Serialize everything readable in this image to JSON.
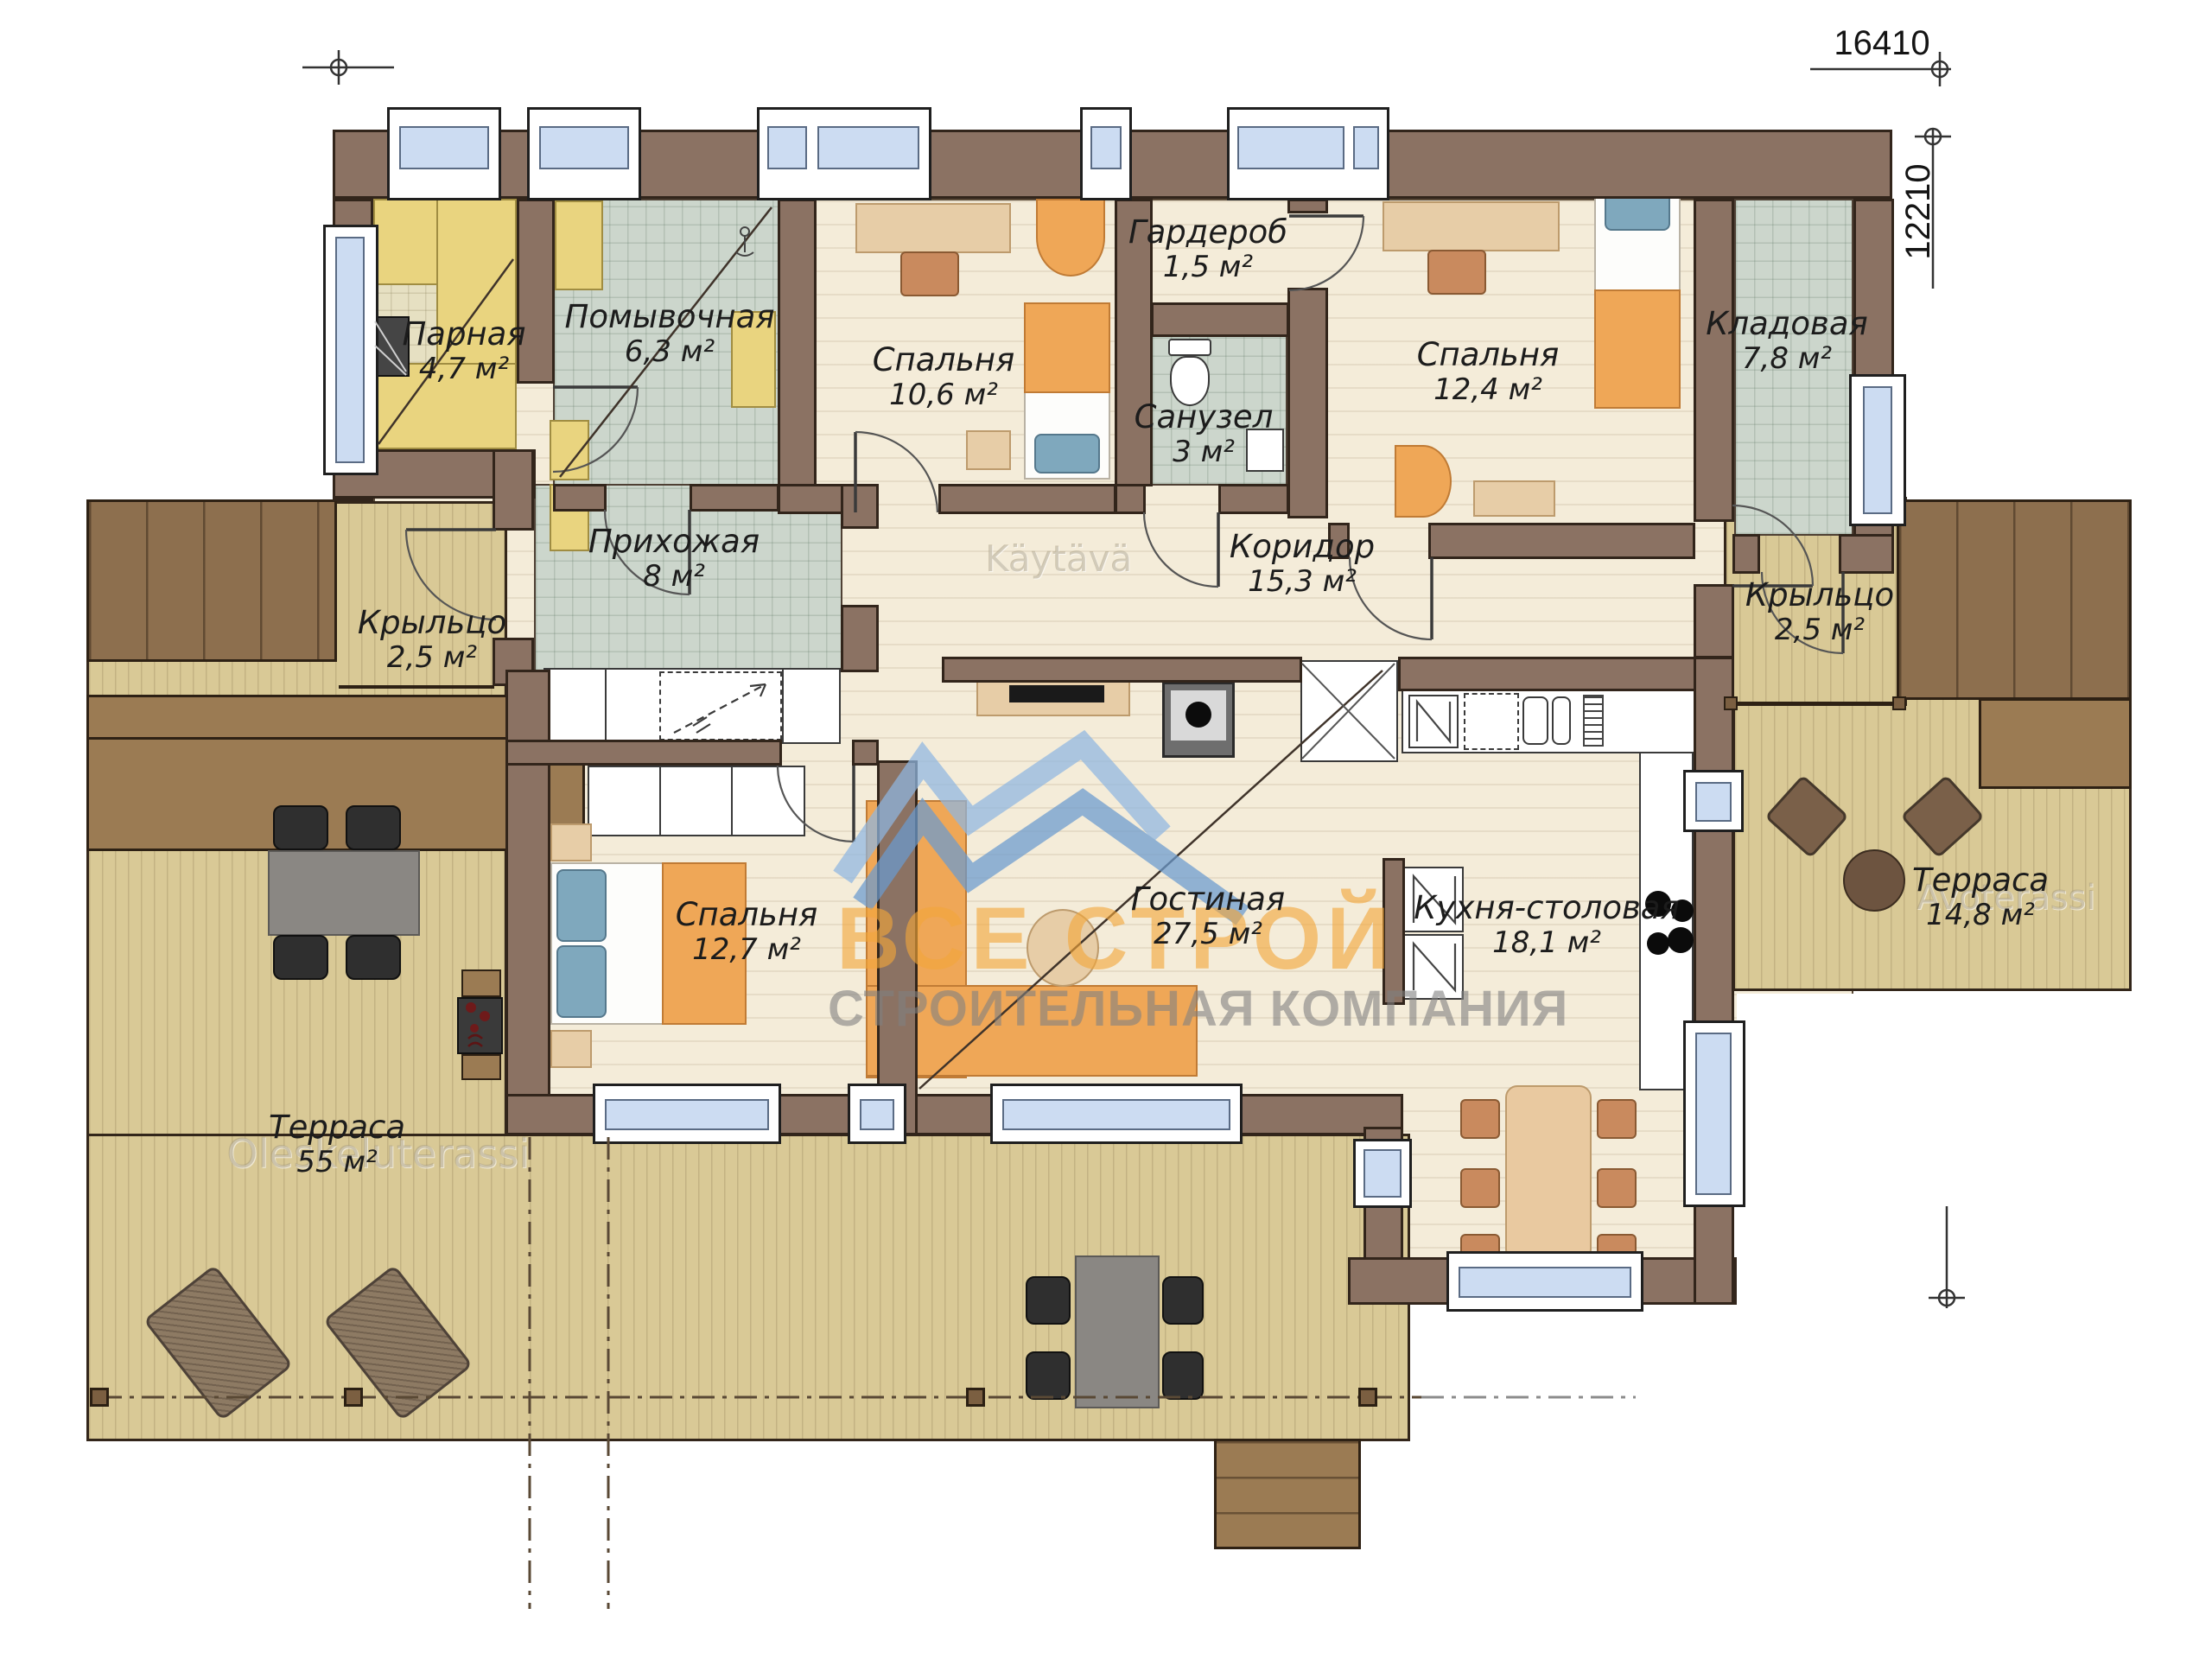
{
  "plan": {
    "dimensions": {
      "width_label": "16410",
      "height_label": "12210"
    },
    "rooms": [
      {
        "id": "parnaya",
        "name": "Парная",
        "area": "4,7 м²"
      },
      {
        "id": "pomyvochnaya",
        "name": "Помывочная",
        "area": "6,3 м²"
      },
      {
        "id": "spalnya-106",
        "name": "Спальня",
        "area": "10,6 м²"
      },
      {
        "id": "garderob",
        "name": "Гардероб",
        "area": "1,5 м²"
      },
      {
        "id": "sanuzel",
        "name": "Санузел",
        "area": "3 м²"
      },
      {
        "id": "spalnya-124",
        "name": "Спальня",
        "area": "12,4 м²"
      },
      {
        "id": "kladovaya",
        "name": "Кладовая",
        "area": "7,8 м²"
      },
      {
        "id": "prihozhaya",
        "name": "Прихожая",
        "area": "8 м²"
      },
      {
        "id": "koridor",
        "name": "Коридор",
        "area": "15,3 м²"
      },
      {
        "id": "kryltso-left",
        "name": "Крыльцо",
        "area": "2,5 м²"
      },
      {
        "id": "kryltso-right",
        "name": "Крыльцо",
        "area": "2,5 м²"
      },
      {
        "id": "spalnya-127",
        "name": "Спальня",
        "area": "12,7 м²"
      },
      {
        "id": "gostinaya",
        "name": "Гостиная",
        "area": "27,5 м²"
      },
      {
        "id": "kuhnya",
        "name": "Кухня-столовая",
        "area": "18,1 м²"
      },
      {
        "id": "terrasa-55",
        "name": "Терраса",
        "area": "55 м²"
      },
      {
        "id": "terrasa-148",
        "name": "Терраса",
        "area": "14,8 м²"
      }
    ],
    "logo": {
      "line1": "ВСЕ СТРОЙ",
      "line2": "СТРОИТЕЛЬНАЯ КОМПАНИЯ"
    },
    "watermarks": {
      "corridor": "Käytävä",
      "terrace_left": "Oleskeluterassi",
      "terrace_right": "Avoterassi"
    },
    "colors": {
      "wall": "#8b7263",
      "floor_wood": "#f4ecd9",
      "floor_tile": "#ccd6cc",
      "terrace": "#d9c996",
      "steps": "#8d6f4e",
      "furniture_accent": "#efa757",
      "window_glass": "#ccdcf2",
      "logo_orange": "#f2a73a",
      "logo_blue": "#7fa9dc",
      "logo_gray": "#808080"
    }
  }
}
